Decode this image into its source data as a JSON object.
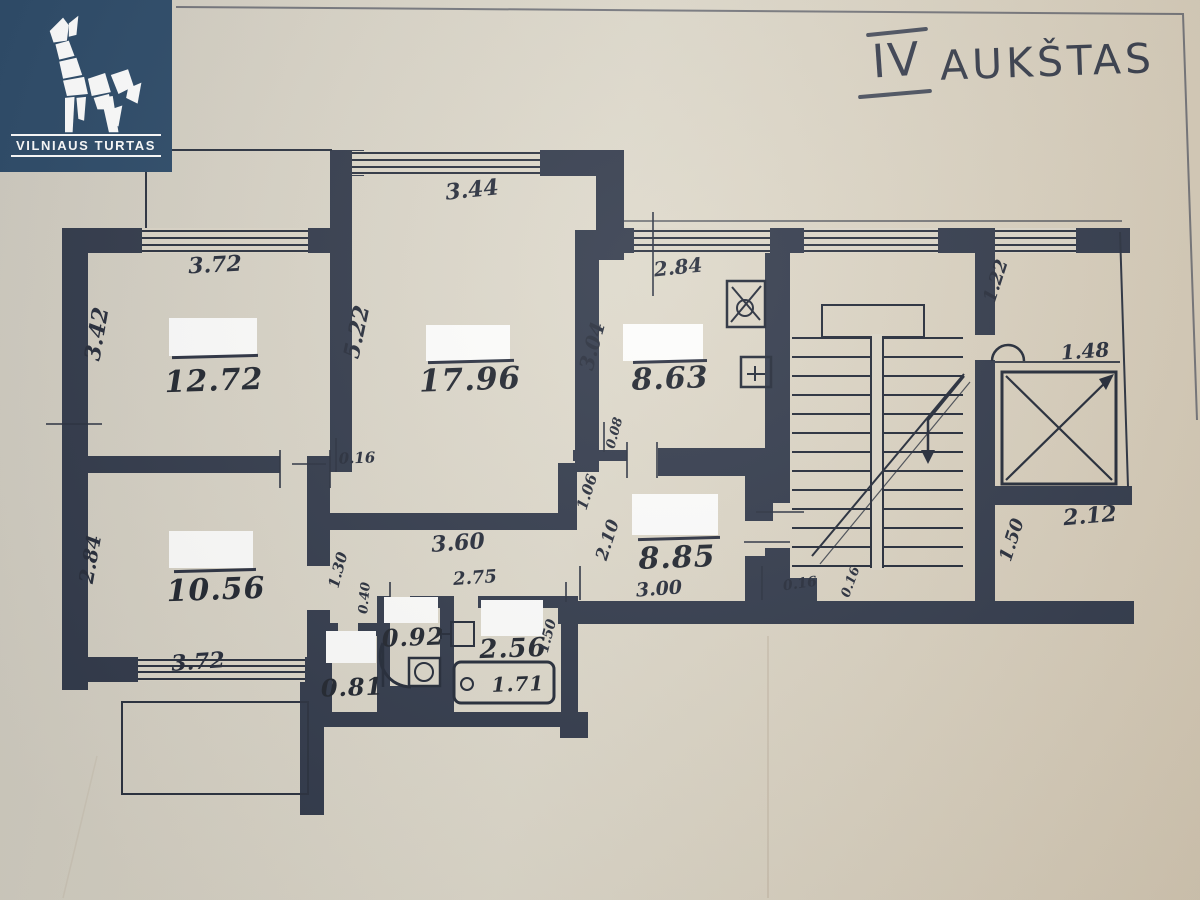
{
  "branding": {
    "company": "VILNIAUS TURTAS",
    "logo_bg": "#2d4b69",
    "logo_icon": "wolf-icon"
  },
  "title": {
    "numeral": "IV",
    "word": "AUKŠTAS"
  },
  "colors": {
    "paper": "#d9d3c5",
    "ink": "#323a4b",
    "logo_text": "#ffffff"
  },
  "rooms": [
    {
      "name": "room-top-left",
      "area": "12.72"
    },
    {
      "name": "room-top-middle",
      "area": "17.96"
    },
    {
      "name": "kitchen",
      "area": "8.63"
    },
    {
      "name": "room-bottom-left",
      "area": "10.56"
    },
    {
      "name": "hall",
      "area": "8.85"
    },
    {
      "name": "wc",
      "area": "0.92"
    },
    {
      "name": "bathroom",
      "area": "2.56"
    },
    {
      "name": "closet",
      "area": "0.81"
    },
    {
      "name": "bathtub",
      "area": "1.71"
    }
  ],
  "dims": [
    {
      "t": "3.72"
    },
    {
      "t": "3.42"
    },
    {
      "t": "3.44"
    },
    {
      "t": "5.22"
    },
    {
      "t": "2.84"
    },
    {
      "t": "3.04"
    },
    {
      "t": "1.22"
    },
    {
      "t": "1.48"
    },
    {
      "t": "2.12"
    },
    {
      "t": "1.50"
    },
    {
      "t": "0.16"
    },
    {
      "t": "0.08"
    },
    {
      "t": "1.06"
    },
    {
      "t": "2.10"
    },
    {
      "t": "3.00"
    },
    {
      "t": "0.16"
    },
    {
      "t": "0.16"
    },
    {
      "t": "3.60"
    },
    {
      "t": "2.75"
    },
    {
      "t": "1.30"
    },
    {
      "t": "0.40"
    },
    {
      "t": "1.50"
    },
    {
      "t": "2.84"
    },
    {
      "t": "3.72"
    }
  ]
}
